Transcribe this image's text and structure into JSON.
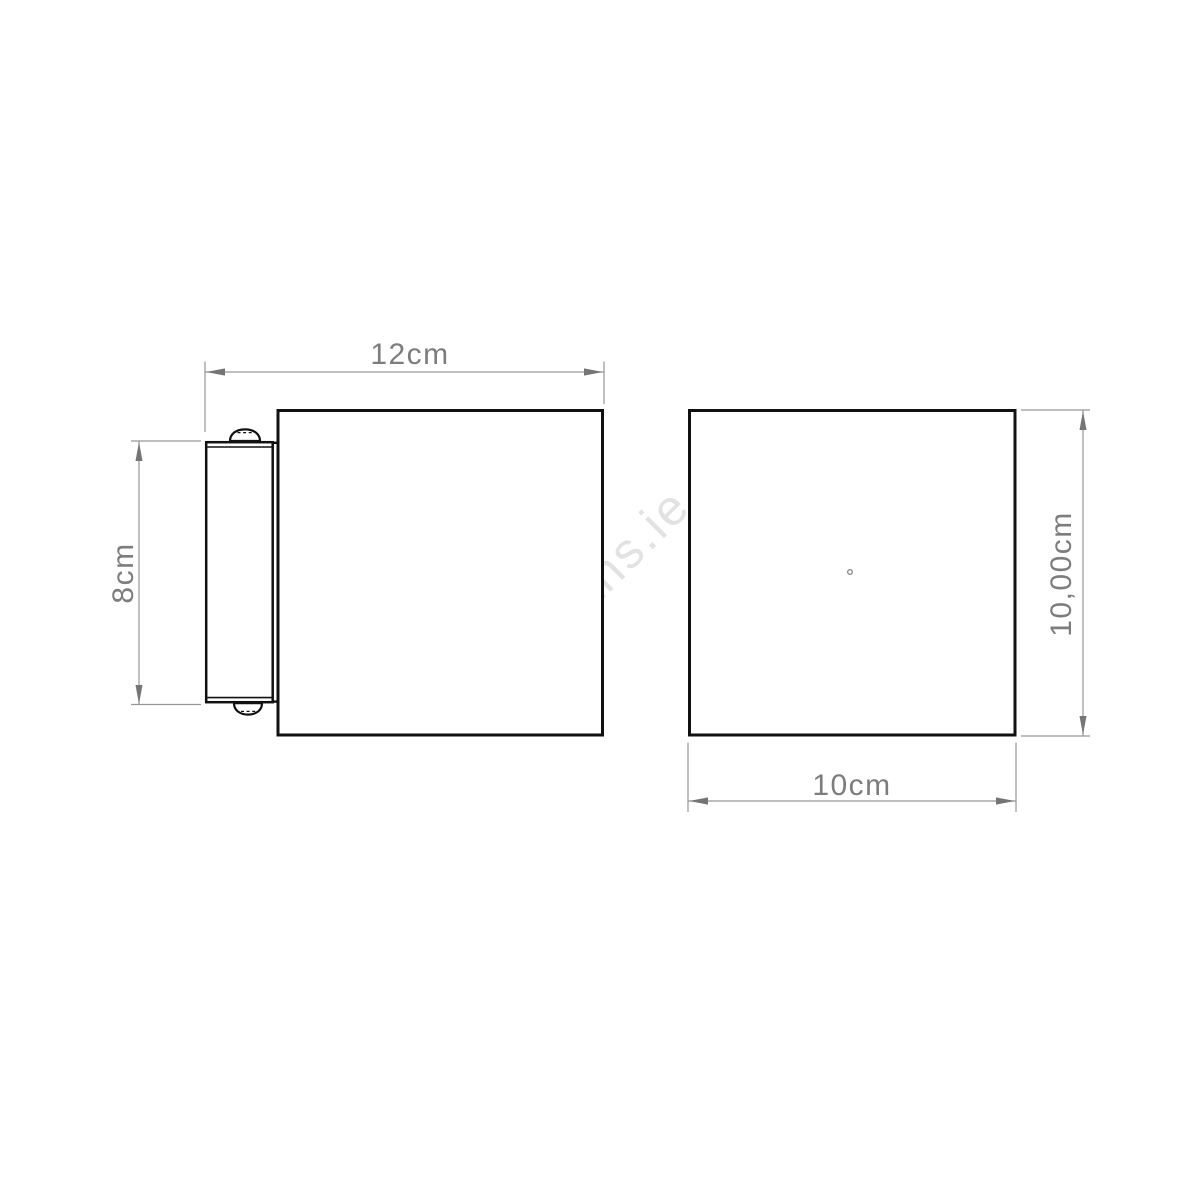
{
  "watermark": {
    "text": "alasans.ie",
    "color": "#e2e2e2"
  },
  "views": {
    "side": {
      "title": "side view with wall bracket"
    },
    "front": {
      "title": "front view"
    }
  },
  "dimensions": {
    "side_overall_width": "12cm",
    "side_bracket_height": "8cm",
    "front_height": "10,00cm",
    "front_width": "10cm"
  },
  "colors": {
    "outline": "#111111",
    "dimension_line": "#969696",
    "dimension_text": "#7d7d7d",
    "arrow": "#757575",
    "watermark": "#e2e2e2",
    "background": "#ffffff"
  }
}
